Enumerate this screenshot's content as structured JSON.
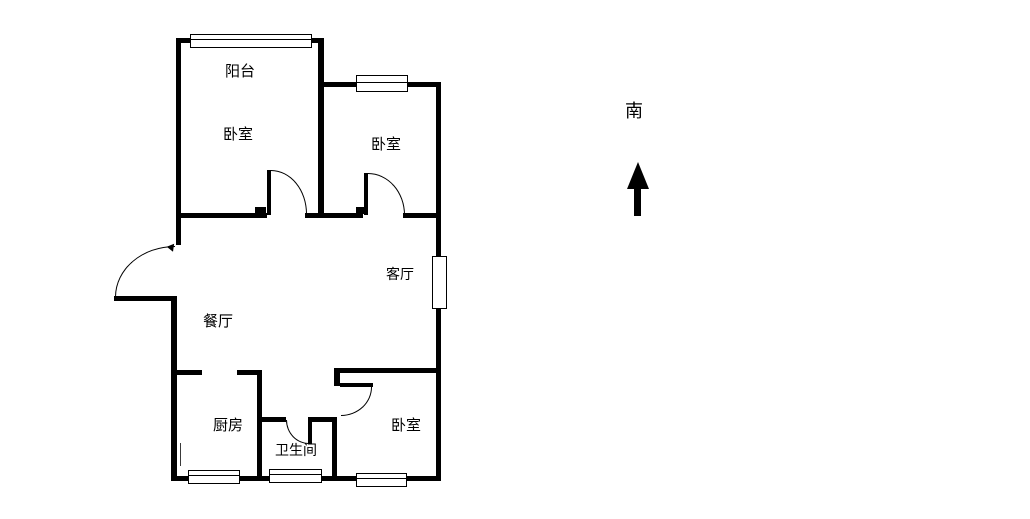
{
  "colors": {
    "wall": "#000000",
    "background": "#ffffff",
    "text": "#000000"
  },
  "compass": {
    "label": "南",
    "arrow_icon": "up-arrow"
  },
  "rooms": {
    "balcony": {
      "label": "阳台"
    },
    "bedroom_top_left": {
      "label": "卧室"
    },
    "bedroom_top_right": {
      "label": "卧室"
    },
    "living_room": {
      "label": "客厅"
    },
    "dining_room": {
      "label": "餐厅"
    },
    "kitchen": {
      "label": "厨房"
    },
    "bathroom": {
      "label": "卫生间"
    },
    "bedroom_bottom_right": {
      "label": "卧室"
    }
  }
}
